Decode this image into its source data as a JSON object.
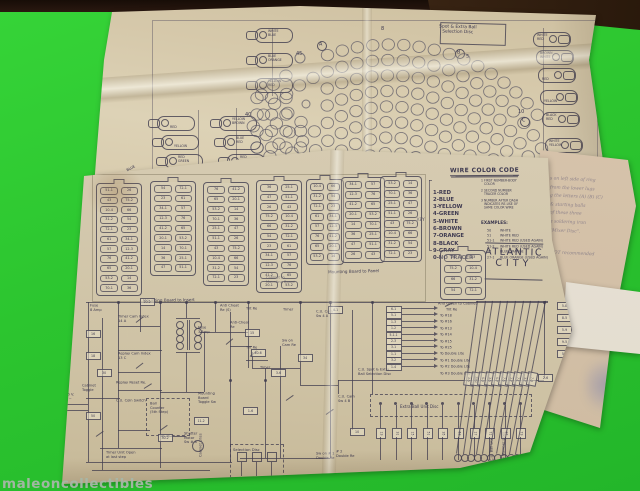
{
  "background": {
    "green": "#2cc52f",
    "top_band": "#20130b",
    "wood": "#4a2f1a"
  },
  "watermark": {
    "text": "maleoncollectibles"
  },
  "upper_sheet": {
    "selection_disc_label": "Spot & Extra Ball\nSelection Disc",
    "extra_wire_note": "Extra Wire",
    "lamps_left": [
      {
        "x": 246,
        "y": 28,
        "label": "WHITE\nBLUE"
      },
      {
        "x": 246,
        "y": 53,
        "label": "BLUE\nORANGE"
      },
      {
        "x": 246,
        "y": 78,
        "label": "YELLOW\nRED"
      },
      {
        "x": 148,
        "y": 116,
        "label": "RED"
      },
      {
        "x": 152,
        "y": 135,
        "label": "YELLOW"
      },
      {
        "x": 156,
        "y": 154,
        "label": "RED\nGREEN"
      },
      {
        "x": 161,
        "y": 174,
        "label": ""
      },
      {
        "x": 166,
        "y": 194,
        "label": ""
      },
      {
        "x": 210,
        "y": 116,
        "label": "YELLOW\nBROWN"
      },
      {
        "x": 214,
        "y": 135,
        "label": "BLUE\nRED"
      },
      {
        "x": 218,
        "y": 154,
        "label": "RED\nBLACK"
      },
      {
        "x": 222,
        "y": 175,
        "label": "BLUE\nORANGE"
      },
      {
        "x": 226,
        "y": 195,
        "label": "RED\nBLACK"
      }
    ],
    "lamps_right": [
      {
        "x": 524,
        "y": 32,
        "label": "WHITE\nRED"
      },
      {
        "x": 527,
        "y": 50,
        "label": "BROWN\nWHITE"
      },
      {
        "x": 529,
        "y": 68,
        "label": "RED"
      },
      {
        "x": 531,
        "y": 90,
        "label": "YELLOW"
      },
      {
        "x": 533,
        "y": 112,
        "label": "BLACK\nRED"
      },
      {
        "x": 536,
        "y": 138,
        "label": "WHITE\nYELLOW"
      },
      {
        "x": 538,
        "y": 160,
        "label": "BLUE"
      },
      {
        "x": 541,
        "y": 181,
        "label": "BROWN\nBLACK"
      }
    ],
    "side_tag": "BLUE",
    "markers": [
      {
        "x": 296,
        "y": 42,
        "t": "45",
        "circled": false
      },
      {
        "x": 317,
        "y": 41,
        "t": "A",
        "circled": true
      },
      {
        "x": 455,
        "y": 49,
        "t": "B",
        "circled": true
      },
      {
        "x": 466,
        "y": 45,
        "t": "5",
        "circled": false
      },
      {
        "x": 245,
        "y": 103,
        "t": "40",
        "circled": false
      },
      {
        "x": 518,
        "y": 100,
        "t": "10",
        "circled": false
      },
      {
        "x": 520,
        "y": 117,
        "t": "C",
        "circled": true
      },
      {
        "x": 381,
        "y": 17,
        "t": "8",
        "circled": false
      }
    ],
    "hole_fan": {
      "cx": 390,
      "cy": 234,
      "r0": 50,
      "dr": 15.5,
      "rings": 10,
      "spacing": 15.5,
      "hole_rx": 6.2,
      "hole_ry": 5.7,
      "clip": [
        252,
        28,
        546,
        196
      ]
    },
    "left_cluster": {
      "x0": 257,
      "y0": 98,
      "dx": 14.5,
      "dy": 16.5,
      "cols": 4,
      "rows": 6
    },
    "big_circles": [
      {
        "x": 390,
        "y": 180,
        "r": 13
      },
      {
        "x": 350,
        "y": 170,
        "r": 8
      },
      {
        "x": 300,
        "y": 58,
        "r": 5
      },
      {
        "x": 306,
        "y": 104,
        "r": 4
      }
    ]
  },
  "notes_sheet": {
    "lines": [
      "s on left side of ring",
      "from the lower lugs",
      "g the letters (A) (B) (C)",
      "& starting balls",
      "of these three",
      "a soldering iron",
      "\"Mixer Disc\".",
      "NOT recommended"
    ]
  },
  "lower_sheet": {
    "wire_color_code": {
      "title": "WIRE COLOR CODE",
      "entries": [
        "1-RED",
        "2-BLUE",
        "3-YELLOW",
        "4-GREEN",
        "5-WHITE",
        "6-BROWN",
        "7-ORANGE",
        "8-BLACK",
        "9-GRAY",
        "0-NO TRACER"
      ],
      "notes": [
        "1 FIRST NUMBER-BODY\n   COLOR",
        "2 SECOND NUMBER\n   TRACER COLOR",
        "3 NUMBER AFTER DASH\n   INDICATES RE-USE OF\n   SAME COLOR WIRE"
      ],
      "examples_title": "EXAMPLES:",
      "examples": [
        [
          "50",
          "WHITE"
        ],
        [
          "51",
          "WHITE RED"
        ],
        [
          "51-1",
          "WHITE RED (USED AGAIN)"
        ],
        [
          "51-2",
          "WHITE RED (USED AGAIN)"
        ],
        [
          "27",
          "BLUE ORANGE"
        ],
        [
          "27-1",
          "BLUE ORANGE (USED AGAIN)"
        ]
      ],
      "key_label": "KEY"
    },
    "title_block": {
      "line1": "ATLANTIC",
      "line2": "CITY"
    },
    "captions": {
      "insert": "Mounting Board to Insert",
      "panel": "Mounting Board to Panel",
      "cabinet_small": "And Green to Cabinet",
      "cabinet_right": "Cabinet to\nMounting Board"
    },
    "strips": [
      {
        "x": 96,
        "y": 183,
        "w": 38,
        "rows": 11
      },
      {
        "x": 150,
        "y": 181,
        "w": 38,
        "rows": 9
      },
      {
        "x": 203,
        "y": 182,
        "w": 38,
        "rows": 10
      },
      {
        "x": 256,
        "y": 180,
        "w": 38,
        "rows": 11
      },
      {
        "x": 306,
        "y": 179,
        "w": 30,
        "rows": 8
      },
      {
        "x": 341,
        "y": 177,
        "w": 36,
        "rows": 8
      },
      {
        "x": 380,
        "y": 176,
        "w": 34,
        "rows": 8
      },
      {
        "x": 440,
        "y": 250,
        "w": 38,
        "rows": 4
      }
    ],
    "pill_codes": [
      "51-1",
      "26",
      "43",
      "75-2",
      "10-4",
      "66",
      "31-2",
      "54",
      "72-1",
      "23",
      "61",
      "34-1",
      "57",
      "12-3",
      "76",
      "41-2",
      "65",
      "20-1",
      "53-2",
      "14",
      "70-1",
      "36",
      "25-1",
      "47"
    ],
    "schematic": {
      "labels": [
        {
          "x": 90,
          "y": 304,
          "t": "Fuse\n8 Amp"
        },
        {
          "x": 118,
          "y": 315,
          "t": "Timer Cam Index\n14 A"
        },
        {
          "x": 118,
          "y": 352,
          "t": "Replay Cam Index\n13 C"
        },
        {
          "x": 116,
          "y": 372,
          "t": "Replay Reset Re."
        },
        {
          "x": 116,
          "y": 390,
          "t": "C.U. Coin Switch"
        },
        {
          "x": 82,
          "y": 384,
          "t": "Cabinet\nToggle"
        },
        {
          "x": 63,
          "y": 393,
          "t": "115 V.\n60 ~"
        },
        {
          "x": 150,
          "y": 402,
          "t": "Ball\nCounter\n(5th Step)"
        },
        {
          "x": 184,
          "y": 432,
          "t": "Shutter\nMotor\nSw # 8"
        },
        {
          "x": 106,
          "y": 451,
          "t": "Timer Unit Open\nat last step"
        },
        {
          "x": 198,
          "y": 326,
          "t": "Fuse\n3 Amp"
        },
        {
          "x": 220,
          "y": 304,
          "t": "Anti Cheat\nRe (S)"
        },
        {
          "x": 230,
          "y": 321,
          "t": "Anti-Cheat\nRe"
        },
        {
          "x": 246,
          "y": 298,
          "t": "Tilt Re"
        },
        {
          "x": 246,
          "y": 337,
          "t": "Tilt Re"
        },
        {
          "x": 260,
          "y": 357,
          "t": "Timer"
        },
        {
          "x": 282,
          "y": 339,
          "t": "Sw on\nCam Re"
        },
        {
          "x": 198,
          "y": 392,
          "t": "Mounting\nBoard\nToggle Sw"
        },
        {
          "x": 199,
          "y": 448,
          "t": "Cabinet Lites",
          "vert": true
        },
        {
          "x": 316,
          "y": 310,
          "t": "C.U. Cam\nSw 4 A"
        },
        {
          "x": 338,
          "y": 395,
          "t": "C.U. Cam\nSw 4 B"
        },
        {
          "x": 358,
          "y": 368,
          "t": "C.U. Spot & Extra\nBall Selection Disc"
        },
        {
          "x": 283,
          "y": 299,
          "t": "Timer"
        },
        {
          "x": 446,
          "y": 299,
          "t": "Tilt Re"
        },
        {
          "x": 316,
          "y": 452,
          "t": "Sw on # 1\nDouble Re"
        },
        {
          "x": 336,
          "y": 450,
          "t": "# 2\nDouble Re"
        },
        {
          "x": 490,
          "y": 452,
          "t": "C.U. Ball Lite",
          "vert": true
        },
        {
          "x": 502,
          "y": 452,
          "t": "To Number Lites",
          "vert": true
        }
      ],
      "tags": [
        {
          "x": 140,
          "y": 298,
          "t": "20-2"
        },
        {
          "x": 86,
          "y": 330,
          "t": "16"
        },
        {
          "x": 86,
          "y": 352,
          "t": "18"
        },
        {
          "x": 97,
          "y": 369,
          "t": "30"
        },
        {
          "x": 158,
          "y": 434,
          "t": "30-2"
        },
        {
          "x": 245,
          "y": 329,
          "t": "15"
        },
        {
          "x": 251,
          "y": 349,
          "t": "40-6"
        },
        {
          "x": 271,
          "y": 369,
          "t": "3-6"
        },
        {
          "x": 243,
          "y": 407,
          "t": "1-6"
        },
        {
          "x": 194,
          "y": 417,
          "t": "11-2"
        },
        {
          "x": 298,
          "y": 354,
          "t": "34"
        },
        {
          "x": 328,
          "y": 306,
          "t": "4-1"
        },
        {
          "x": 538,
          "y": 374,
          "t": "2-6"
        },
        {
          "x": 350,
          "y": 428,
          "t": "10"
        },
        {
          "x": 86,
          "y": 412,
          "t": "50"
        },
        {
          "x": 557,
          "y": 302,
          "t": "5-8"
        },
        {
          "x": 557,
          "y": 314,
          "t": "8-5"
        },
        {
          "x": 557,
          "y": 326,
          "t": "5-9"
        },
        {
          "x": 557,
          "y": 338,
          "t": "9-5"
        },
        {
          "x": 557,
          "y": 350,
          "t": "5-0"
        }
      ],
      "ladder": {
        "codes": [
          "6-1",
          "5-1",
          "1-3",
          "1-2",
          "5-1-1",
          "2-3",
          "3-1",
          "1-1",
          "3-2",
          "1-4"
        ],
        "labels": [
          "To #18",
          "To #16",
          "To #13",
          "To #14",
          "To #15",
          "To #25",
          "To Double Lite",
          "To #1 Double Lite",
          "To #2 Double Lite",
          "To #3 Double Lite"
        ]
      },
      "extra_ball_unit": {
        "caption": "Extra Ball Unit Disc",
        "codes": [
          "13",
          "31",
          "15",
          "51",
          "35",
          "53",
          "17",
          "71",
          "37",
          "73"
        ]
      },
      "bundle_codes": [
        "1-5",
        "15-1",
        "5-3",
        "3-5",
        "5-7",
        "7-5",
        "1-7",
        "7-1",
        "3-7",
        "7-3"
      ],
      "selection_disc_caption": "Selection Disc"
    }
  }
}
